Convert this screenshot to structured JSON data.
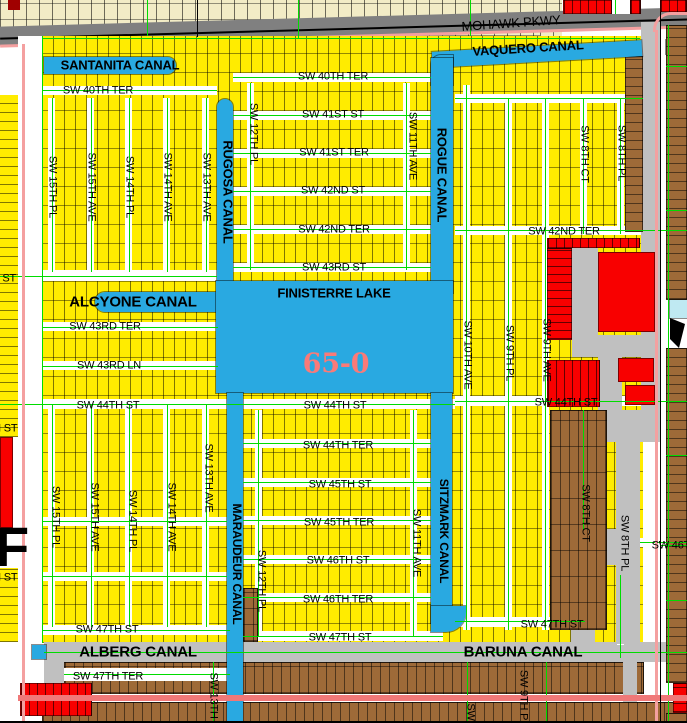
{
  "region_code": "65-0",
  "colors": {
    "yellow": "#FFEC00",
    "cream": "#F2ECC6",
    "brown": "#9E6A38",
    "red": "#F80000",
    "darkred": "#A00000",
    "water": "#29A9E1",
    "pond": "#BFE9F2",
    "roadgray": "#C0C0C0",
    "highway": "#808080",
    "green": "#00DC00",
    "pink": "#F4A0A0",
    "pinkbold": "#F07878",
    "region_label_pink": "#FA7A78",
    "label": "#000000"
  },
  "water_features": [
    "SANTANITA CANAL",
    "VAQUERO CANAL",
    "RUGOSA CANAL",
    "ROGUE CANAL",
    "ALCYONE CANAL",
    "FINISTERRE LAKE",
    "MARAUDEUR CANAL",
    "SITZMARK CANAL",
    "ALBERG CANAL",
    "BARUNA CANAL"
  ],
  "major_roads": [
    "MOHAWK PKWY"
  ],
  "map_shapes": [
    [
      0,
      0,
      562,
      36,
      "cream"
    ],
    [
      540,
      26,
      22,
      12,
      "cream"
    ],
    [
      -2,
      17,
      692,
      19,
      "grayD",
      "",
      -1.6
    ],
    [
      0,
      28,
      690,
      2,
      "blkline",
      "",
      -1.6
    ],
    [
      0,
      35,
      690,
      3,
      "p",
      "",
      -1.6
    ],
    [
      8,
      0,
      12,
      10,
      "dred"
    ],
    [
      563,
      0,
      49,
      14,
      "redv"
    ],
    [
      612,
      0,
      18,
      14,
      "white"
    ],
    [
      630,
      0,
      11,
      14,
      "redv"
    ],
    [
      660,
      0,
      27,
      12,
      "redv"
    ],
    [
      42,
      36,
      601,
      607,
      "yel"
    ],
    [
      0,
      95,
      18,
      342,
      "yelh"
    ],
    [
      0,
      568,
      18,
      74,
      "yelh"
    ],
    [
      18,
      36,
      24,
      687,
      "white"
    ],
    [
      44,
      642,
      643,
      20,
      "grayL"
    ],
    [
      44,
      642,
      20,
      81,
      "grayL"
    ],
    [
      64,
      662,
      580,
      32,
      "brnv2"
    ],
    [
      42,
      702,
      645,
      21,
      "brnv2"
    ],
    [
      64,
      668,
      166,
      13,
      "white"
    ],
    [
      42,
      86,
      175,
      9,
      "white"
    ],
    [
      42,
      270,
      175,
      11,
      "white"
    ],
    [
      42,
      322,
      176,
      9,
      "white"
    ],
    [
      42,
      361,
      176,
      9,
      "white"
    ],
    [
      42,
      399,
      413,
      10,
      "white"
    ],
    [
      455,
      396,
      205,
      10,
      "white"
    ],
    [
      42,
      517,
      185,
      9,
      "white"
    ],
    [
      42,
      572,
      185,
      9,
      "white"
    ],
    [
      42,
      625,
      188,
      10,
      "white"
    ],
    [
      233,
      73,
      198,
      9,
      "white"
    ],
    [
      233,
      111,
      198,
      9,
      "white"
    ],
    [
      233,
      149,
      198,
      9,
      "white"
    ],
    [
      233,
      187,
      198,
      9,
      "white"
    ],
    [
      233,
      225,
      198,
      9,
      "white"
    ],
    [
      233,
      263,
      198,
      9,
      "white"
    ],
    [
      243,
      439,
      188,
      9,
      "white"
    ],
    [
      243,
      478,
      188,
      9,
      "white"
    ],
    [
      243,
      516,
      188,
      9,
      "white"
    ],
    [
      243,
      555,
      188,
      9,
      "white"
    ],
    [
      243,
      593,
      188,
      9,
      "white"
    ],
    [
      243,
      631,
      200,
      10,
      "white"
    ],
    [
      455,
      226,
      188,
      9,
      "white"
    ],
    [
      455,
      94,
      188,
      9,
      "white"
    ],
    [
      640,
      538,
      47,
      9,
      "white"
    ],
    [
      455,
      617,
      130,
      10,
      "white"
    ],
    [
      48,
      98,
      7,
      174,
      "white"
    ],
    [
      87,
      98,
      7,
      174,
      "white"
    ],
    [
      125,
      98,
      7,
      174,
      "white"
    ],
    [
      163,
      98,
      7,
      174,
      "white"
    ],
    [
      202,
      98,
      7,
      174,
      "white"
    ],
    [
      48,
      405,
      7,
      222,
      "white"
    ],
    [
      87,
      405,
      7,
      222,
      "white"
    ],
    [
      125,
      405,
      7,
      222,
      "white"
    ],
    [
      163,
      405,
      7,
      222,
      "white"
    ],
    [
      202,
      405,
      7,
      222,
      "white"
    ],
    [
      247,
      83,
      7,
      187,
      "white"
    ],
    [
      403,
      83,
      7,
      187,
      "white"
    ],
    [
      255,
      410,
      7,
      226,
      "white"
    ],
    [
      410,
      410,
      7,
      226,
      "white"
    ],
    [
      463,
      85,
      7,
      545,
      "white"
    ],
    [
      505,
      98,
      7,
      532,
      "white"
    ],
    [
      542,
      98,
      7,
      532,
      "white"
    ],
    [
      580,
      98,
      7,
      136,
      "white"
    ],
    [
      617,
      98,
      7,
      136,
      "white"
    ],
    [
      580,
      410,
      7,
      120,
      "white"
    ],
    [
      617,
      575,
      7,
      70,
      "white"
    ],
    [
      641,
      22,
      19,
      390,
      "grayL"
    ],
    [
      600,
      410,
      60,
      32,
      "grayL"
    ],
    [
      616,
      442,
      24,
      202,
      "grayL"
    ],
    [
      580,
      529,
      47,
      36,
      "grayL"
    ],
    [
      571,
      610,
      24,
      34,
      "grayL"
    ],
    [
      623,
      658,
      14,
      44,
      "grayL"
    ],
    [
      572,
      243,
      26,
      95,
      "grayL"
    ],
    [
      572,
      335,
      85,
      22,
      "grayL"
    ],
    [
      598,
      357,
      24,
      53,
      "grayL"
    ],
    [
      547,
      238,
      93,
      10,
      "redv"
    ],
    [
      547,
      248,
      25,
      92,
      "redh"
    ],
    [
      598,
      252,
      57,
      80,
      "red"
    ],
    [
      547,
      360,
      53,
      47,
      "redv"
    ],
    [
      618,
      358,
      36,
      24,
      "red"
    ],
    [
      625,
      385,
      30,
      20,
      "red"
    ],
    [
      625,
      56,
      18,
      176,
      "brnh"
    ],
    [
      550,
      410,
      57,
      220,
      "brnv2"
    ],
    [
      243,
      588,
      15,
      54,
      "brn"
    ],
    [
      44,
      57,
      132,
      17,
      "blue",
      "0 9px 9px 0"
    ],
    [
      217,
      99,
      16,
      196,
      "blue",
      "8px 8px 0 0"
    ],
    [
      432,
      46,
      210,
      16,
      "blue",
      "",
      -3.2
    ],
    [
      431,
      55,
      22,
      30,
      "blue",
      "10px 0 0 0"
    ],
    [
      666,
      40,
      21,
      14,
      "blue"
    ],
    [
      431,
      58,
      22,
      235,
      "blue"
    ],
    [
      95,
      292,
      125,
      20,
      "blue",
      "10px 0 0 10px"
    ],
    [
      216,
      281,
      237,
      112,
      "blue"
    ],
    [
      227,
      393,
      16,
      330,
      "blue"
    ],
    [
      431,
      393,
      21,
      230,
      "blue"
    ],
    [
      431,
      606,
      35,
      26,
      "blue",
      "0 0 20px 0"
    ],
    [
      32,
      645,
      14,
      14,
      "blue"
    ],
    [
      666,
      25,
      21,
      275,
      "brnh"
    ],
    [
      666,
      348,
      21,
      335,
      "brnh"
    ],
    [
      673,
      683,
      14,
      30,
      "redh"
    ],
    [
      666,
      713,
      21,
      10,
      "brnh"
    ],
    [
      670,
      300,
      17,
      18,
      "cyan"
    ],
    [
      670,
      318,
      15,
      30,
      "blkw"
    ],
    [
      0,
      437,
      13,
      91,
      "red"
    ],
    [
      20,
      683,
      72,
      33,
      "redv"
    ],
    [
      42,
      38,
      598,
      1,
      "g"
    ],
    [
      42,
      90,
      175,
      1,
      "g"
    ],
    [
      0,
      276,
      217,
      1,
      "g"
    ],
    [
      42,
      327,
      176,
      1,
      "g"
    ],
    [
      42,
      366,
      176,
      1,
      "g"
    ],
    [
      0,
      404,
      455,
      1,
      "g"
    ],
    [
      455,
      401,
      232,
      1,
      "g"
    ],
    [
      42,
      521,
      185,
      1,
      "g"
    ],
    [
      42,
      576,
      185,
      1,
      "g"
    ],
    [
      42,
      630,
      188,
      1,
      "g"
    ],
    [
      233,
      77,
      198,
      1,
      "g"
    ],
    [
      233,
      115,
      198,
      1,
      "g"
    ],
    [
      233,
      153,
      198,
      1,
      "g"
    ],
    [
      233,
      191,
      198,
      1,
      "g"
    ],
    [
      233,
      229,
      198,
      1,
      "g"
    ],
    [
      233,
      267,
      198,
      1,
      "g"
    ],
    [
      243,
      443,
      188,
      1,
      "g"
    ],
    [
      243,
      482,
      188,
      1,
      "g"
    ],
    [
      243,
      520,
      188,
      1,
      "g"
    ],
    [
      243,
      559,
      188,
      1,
      "g"
    ],
    [
      243,
      597,
      188,
      1,
      "g"
    ],
    [
      243,
      636,
      200,
      1,
      "g"
    ],
    [
      455,
      230,
      232,
      1,
      "g"
    ],
    [
      455,
      98,
      188,
      1,
      "g"
    ],
    [
      640,
      542,
      47,
      1,
      "g"
    ],
    [
      455,
      621,
      130,
      1,
      "g"
    ],
    [
      44,
      652,
      643,
      1,
      "g"
    ],
    [
      64,
      674,
      166,
      1,
      "g"
    ],
    [
      42,
      36,
      1,
      607,
      "g"
    ],
    [
      52,
      98,
      1,
      174,
      "g"
    ],
    [
      91,
      98,
      1,
      174,
      "g"
    ],
    [
      129,
      98,
      1,
      174,
      "g"
    ],
    [
      167,
      98,
      1,
      174,
      "g"
    ],
    [
      206,
      98,
      1,
      174,
      "g"
    ],
    [
      52,
      405,
      1,
      222,
      "g"
    ],
    [
      91,
      405,
      1,
      222,
      "g"
    ],
    [
      129,
      405,
      1,
      222,
      "g"
    ],
    [
      167,
      405,
      1,
      222,
      "g"
    ],
    [
      206,
      405,
      1,
      222,
      "g"
    ],
    [
      250,
      83,
      1,
      187,
      "g"
    ],
    [
      406,
      83,
      1,
      187,
      "g"
    ],
    [
      258,
      410,
      1,
      226,
      "g"
    ],
    [
      413,
      410,
      1,
      226,
      "g"
    ],
    [
      466,
      85,
      1,
      545,
      "g"
    ],
    [
      508,
      98,
      1,
      532,
      "g"
    ],
    [
      545,
      98,
      1,
      532,
      "g"
    ],
    [
      583,
      98,
      1,
      136,
      "g"
    ],
    [
      620,
      98,
      1,
      136,
      "g"
    ],
    [
      583,
      410,
      1,
      120,
      "g"
    ],
    [
      620,
      575,
      1,
      83,
      "g"
    ],
    [
      668,
      25,
      1,
      698,
      "g"
    ],
    [
      147,
      0,
      1,
      36,
      "g"
    ],
    [
      298,
      0,
      1,
      38,
      "g"
    ],
    [
      470,
      0,
      1,
      36,
      "g"
    ],
    [
      615,
      0,
      1,
      14,
      "g"
    ],
    [
      666,
      66,
      21,
      1,
      "g"
    ],
    [
      666,
      210,
      21,
      1,
      "g"
    ],
    [
      666,
      455,
      21,
      1,
      "g"
    ],
    [
      660,
      545,
      27,
      1,
      "g"
    ],
    [
      666,
      600,
      21,
      1,
      "g"
    ],
    [
      213,
      662,
      1,
      61,
      "g"
    ],
    [
      467,
      662,
      1,
      61,
      "g"
    ],
    [
      546,
      662,
      1,
      61,
      "g"
    ],
    [
      22,
      44,
      3,
      679,
      "p"
    ],
    [
      655,
      30,
      3,
      693,
      "p"
    ],
    [
      18,
      695,
      669,
      6,
      "P"
    ],
    [
      653,
      12,
      34,
      20,
      "arc"
    ],
    [
      197,
      0,
      1,
      37,
      "k"
    ],
    [
      660,
      12,
      1,
      711,
      "k"
    ],
    [
      0,
      721,
      687,
      2,
      "k"
    ]
  ],
  "labels": [
    {
      "t": "MOHAWK PKWY",
      "x": 511,
      "y": 23,
      "r": -4,
      "s": 13,
      "n": "road-label-mohawk-pkwy"
    },
    {
      "t": "SANTANITA CANAL",
      "x": 120,
      "y": 65,
      "s": 13,
      "w": 700,
      "n": "canal-label-santanita"
    },
    {
      "t": "VAQUERO CANAL",
      "x": 528,
      "y": 48,
      "r": -3.5,
      "s": 13,
      "w": 700,
      "n": "canal-label-vaquero"
    },
    {
      "t": "SW 40TH TER",
      "x": 98,
      "y": 91
    },
    {
      "t": "SW 40TH TER",
      "x": 333,
      "y": 77
    },
    {
      "t": "SW 41ST ST",
      "x": 333,
      "y": 115
    },
    {
      "t": "SW 41ST TER",
      "x": 334,
      "y": 153
    },
    {
      "t": "SW 42ND ST",
      "x": 333,
      "y": 191
    },
    {
      "t": "SW 42ND TER",
      "x": 334,
      "y": 230
    },
    {
      "t": "SW 43RD ST",
      "x": 334,
      "y": 268
    },
    {
      "t": "SW 42ND TER",
      "x": 564,
      "y": 232
    },
    {
      "t": "SW 43RD ST",
      "x": -16,
      "y": 279
    },
    {
      "t": "RUGOSA CANAL",
      "x": 228,
      "y": 192,
      "r": 90,
      "s": 13,
      "w": 700,
      "n": "canal-label-rugosa"
    },
    {
      "t": "ROGUE CANAL",
      "x": 442,
      "y": 175,
      "r": 90,
      "s": 13,
      "w": 700,
      "n": "canal-label-rogue"
    },
    {
      "t": "SW 12TH PL",
      "x": 253,
      "y": 134,
      "r": 90
    },
    {
      "t": "SW 11TH AVE",
      "x": 412,
      "y": 146,
      "r": 90
    },
    {
      "t": "SW 8TH CT",
      "x": 584,
      "y": 154,
      "r": 90
    },
    {
      "t": "SW 8TH PL",
      "x": 621,
      "y": 153,
      "r": 90
    },
    {
      "t": "SW 15TH PL",
      "x": 52,
      "y": 187,
      "r": 90
    },
    {
      "t": "SW 15TH AVE",
      "x": 91,
      "y": 187,
      "r": 90
    },
    {
      "t": "SW 14TH PL",
      "x": 129,
      "y": 187,
      "r": 90
    },
    {
      "t": "SW 14TH AVE",
      "x": 167,
      "y": 187,
      "r": 90
    },
    {
      "t": "SW 13TH AVE",
      "x": 206,
      "y": 187,
      "r": 90
    },
    {
      "t": "ALCYONE CANAL",
      "x": 133,
      "y": 302,
      "s": 15,
      "w": 700,
      "n": "canal-label-alcyone"
    },
    {
      "t": "FINISTERRE LAKE",
      "x": 334,
      "y": 293,
      "s": 13,
      "w": 700,
      "n": "lake-label-finisterre"
    },
    {
      "t": "SW 43RD TER",
      "x": 105,
      "y": 327
    },
    {
      "t": "SW 43RD LN",
      "x": 109,
      "y": 366
    },
    {
      "t": "65-0",
      "x": 336,
      "y": 364,
      "s": 27,
      "w": 700,
      "c": "region_label_pink",
      "f": "serif",
      "n": "plat-code-label"
    },
    {
      "t": "SW 44TH ST",
      "x": 108,
      "y": 406
    },
    {
      "t": "SW 44TH ST",
      "x": 335,
      "y": 406
    },
    {
      "t": "SW 44TH ST",
      "x": 566,
      "y": 403
    },
    {
      "t": "SW 44TH ST",
      "x": -14,
      "y": 429
    },
    {
      "t": "SW 10TH AVE",
      "x": 467,
      "y": 355,
      "r": 90
    },
    {
      "t": "SW 9TH PL",
      "x": 509,
      "y": 353,
      "r": 90
    },
    {
      "t": "SW 9TH AVE",
      "x": 546,
      "y": 350,
      "r": 90
    },
    {
      "t": "SW 44TH TER",
      "x": 338,
      "y": 446
    },
    {
      "t": "SW 45TH ST",
      "x": 340,
      "y": 485
    },
    {
      "t": "SW 45TH TER",
      "x": 339,
      "y": 523
    },
    {
      "t": "SW 46TH ST",
      "x": 338,
      "y": 561
    },
    {
      "t": "SW 46TH TER",
      "x": 338,
      "y": 600
    },
    {
      "t": "SW 46TH ST",
      "x": -14,
      "y": 578
    },
    {
      "t": "SW 46TH ST",
      "x": 683,
      "y": 546
    },
    {
      "t": "SW 15TH PL",
      "x": 55,
      "y": 517,
      "r": 90
    },
    {
      "t": "SW 15TH AVE",
      "x": 94,
      "y": 517,
      "r": 90
    },
    {
      "t": "SW 14TH PL",
      "x": 132,
      "y": 521,
      "r": 90
    },
    {
      "t": "SW 14TH AVE",
      "x": 171,
      "y": 517,
      "r": 90
    },
    {
      "t": "SW 13TH AVE",
      "x": 208,
      "y": 478,
      "r": 90
    },
    {
      "t": "SW 12TH PL",
      "x": 261,
      "y": 581,
      "r": 90
    },
    {
      "t": "SW 11TH AVE",
      "x": 416,
      "y": 543,
      "r": 90
    },
    {
      "t": "SW 8TH CT",
      "x": 585,
      "y": 513,
      "r": 90
    },
    {
      "t": "SW 8TH PL",
      "x": 624,
      "y": 543,
      "r": 90
    },
    {
      "t": "MARAUDEUR CANAL",
      "x": 237,
      "y": 564,
      "r": 90,
      "s": 12,
      "w": 700,
      "n": "canal-label-maraudeur"
    },
    {
      "t": "SITZMARK CANAL",
      "x": 444,
      "y": 531,
      "r": 90,
      "s": 12,
      "w": 700,
      "n": "canal-label-sitzmark"
    },
    {
      "t": "F",
      "x": 12,
      "y": 547,
      "s": 56,
      "w": 900,
      "n": "edge-letter-label"
    },
    {
      "t": "SW 47TH ST",
      "x": 107,
      "y": 630
    },
    {
      "t": "SW 47TH ST",
      "x": 340,
      "y": 638
    },
    {
      "t": "SW 47TH ST",
      "x": 552,
      "y": 625
    },
    {
      "t": "ALBERG CANAL",
      "x": 138,
      "y": 652,
      "s": 15,
      "w": 700,
      "n": "canal-label-alberg"
    },
    {
      "t": "BARUNA CANAL",
      "x": 523,
      "y": 652,
      "s": 15,
      "w": 700,
      "n": "canal-label-baruna"
    },
    {
      "t": "SW 47TH TER",
      "x": 108,
      "y": 677
    },
    {
      "t": "SW 13TH AVE",
      "x": 213,
      "y": 707,
      "r": 90
    },
    {
      "t": "SW 9TH PL",
      "x": 523,
      "y": 698,
      "r": 90
    },
    {
      "t": "SW",
      "x": 470,
      "y": 712,
      "r": 90
    }
  ]
}
